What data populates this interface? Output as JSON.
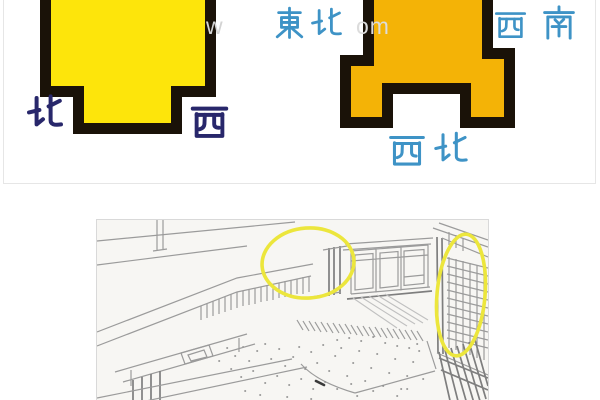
{
  "top_diagram": {
    "border_color": "#e6e6e6",
    "left_shape": {
      "fill": "#fde50b",
      "outline": "#1a1208",
      "label_color": "#28276b",
      "label_left": "北",
      "label_right": "西"
    },
    "right_shape": {
      "fill": "#f4b306",
      "outline": "#1a1208",
      "label_color": "#3e93c6",
      "label_top_left": "東北",
      "label_top_right": "西南",
      "label_bottom": "西北"
    }
  },
  "watermark": {
    "fragment_left": "w",
    "fragment_right": "om"
  },
  "sketch_panel": {
    "border_color": "#d9d9d9",
    "paper_color": "#f7f6f3",
    "line_color": "#9b9b9b",
    "highlight_color": "#ece63c"
  }
}
